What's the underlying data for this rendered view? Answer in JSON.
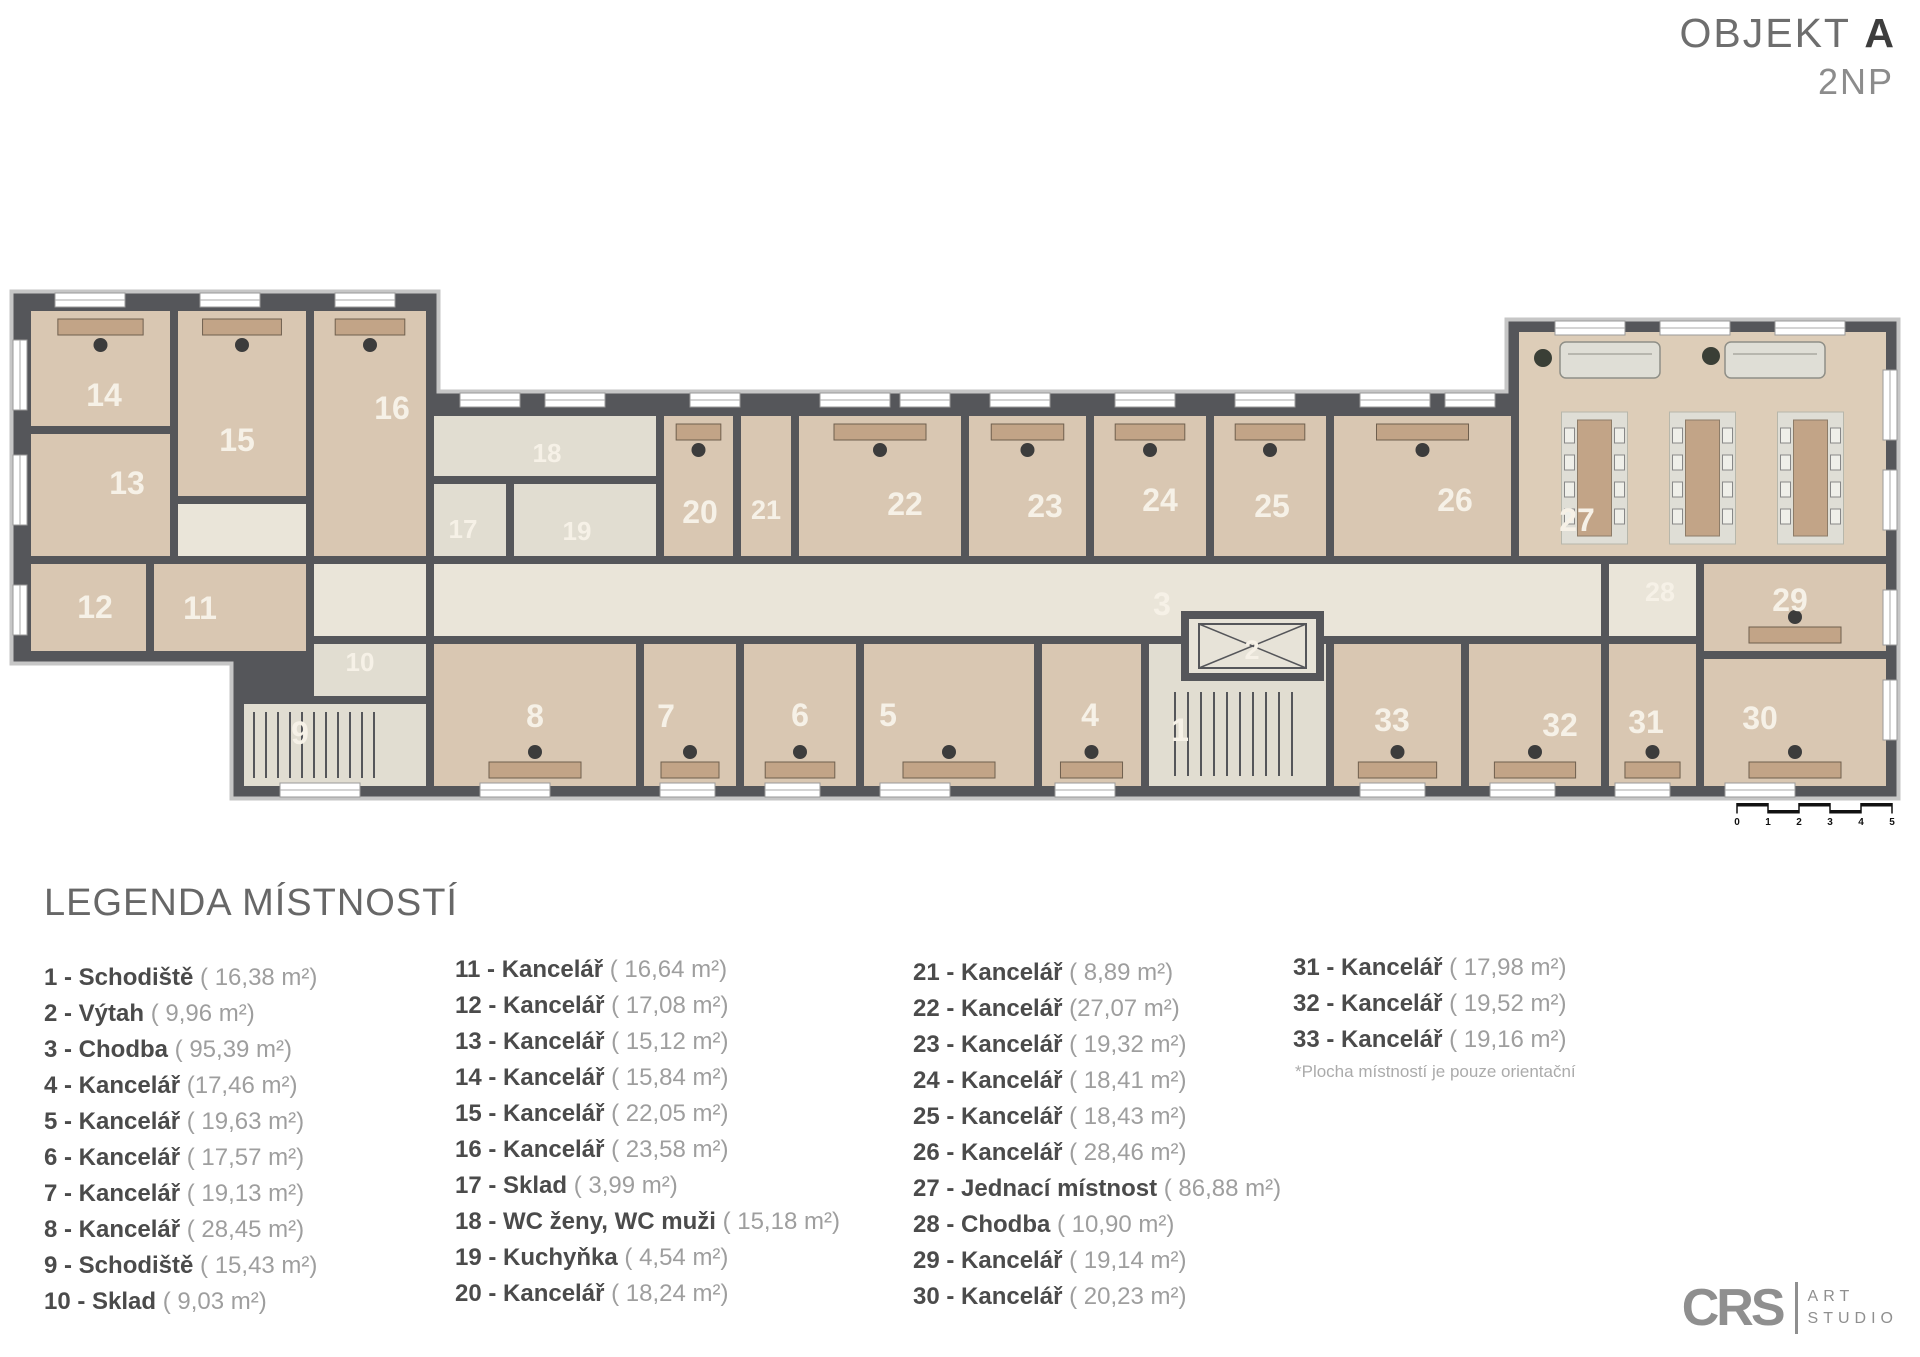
{
  "title": {
    "object": "OBJEKT",
    "object_letter": "A",
    "floor": "2NP"
  },
  "legend": {
    "heading": "LEGENDA MÍSTNOSTÍ",
    "note": "*Plocha místností je pouze orientační",
    "columns": [
      [
        {
          "num": "1",
          "name": "Schodiště",
          "area": "( 16,38 m²)"
        },
        {
          "num": "2",
          "name": "Výtah",
          "area": "( 9,96 m²)"
        },
        {
          "num": "3",
          "name": "Chodba",
          "area": "( 95,39 m²)"
        },
        {
          "num": "4",
          "name": "Kancelář",
          "area": "(17,46  m²)"
        },
        {
          "num": "5",
          "name": "Kancelář",
          "area": "( 19,63 m²)"
        },
        {
          "num": "6",
          "name": "Kancelář",
          "area": "( 17,57 m²)"
        },
        {
          "num": "7",
          "name": "Kancelář",
          "area": "( 19,13 m²)"
        },
        {
          "num": "8",
          "name": "Kancelář",
          "area": "( 28,45 m²)"
        },
        {
          "num": "9",
          "name": "Schodiště",
          "area": "( 15,43 m²)"
        },
        {
          "num": "10",
          "name": "Sklad",
          "area": "( 9,03  m²)"
        }
      ],
      [
        {
          "num": "11",
          "name": "Kancelář",
          "area": "( 16,64 m²)"
        },
        {
          "num": "12",
          "name": "Kancelář",
          "area": "( 17,08 m²)"
        },
        {
          "num": "13",
          "name": "Kancelář",
          "area": "( 15,12 m²)"
        },
        {
          "num": "14",
          "name": "Kancelář",
          "area": "( 15,84 m²)"
        },
        {
          "num": "15",
          "name": "Kancelář",
          "area": "( 22,05 m²)"
        },
        {
          "num": "16",
          "name": "Kancelář",
          "area": "( 23,58 m²)"
        },
        {
          "num": "17",
          "name": "Sklad",
          "area": "( 3,99 m²)"
        },
        {
          "num": "18",
          "name": "WC ženy, WC muži",
          "area": "( 15,18 m²)"
        },
        {
          "num": "19",
          "name": "Kuchyňka",
          "area": "( 4,54 m²)"
        },
        {
          "num": "20",
          "name": "Kancelář",
          "area": "( 18,24 m²)"
        }
      ],
      [
        {
          "num": "21",
          "name": "Kancelář",
          "area": "( 8,89 m²)"
        },
        {
          "num": "22",
          "name": "Kancelář",
          "area": "(27,07 m²)"
        },
        {
          "num": "23",
          "name": "Kancelář",
          "area": "( 19,32 m²)"
        },
        {
          "num": "24",
          "name": "Kancelář",
          "area": "( 18,41 m²)"
        },
        {
          "num": "25",
          "name": "Kancelář",
          "area": "( 18,43 m²)"
        },
        {
          "num": "26",
          "name": "Kancelář",
          "area": "( 28,46 m²)"
        },
        {
          "num": "27",
          "name": "Jednací místnost",
          "area": "( 86,88 m²)"
        },
        {
          "num": "28",
          "name": "Chodba",
          "area": "( 10,90 m²)"
        },
        {
          "num": "29",
          "name": "Kancelář",
          "area": "( 19,14 m²)"
        },
        {
          "num": "30",
          "name": "Kancelář",
          "area": "( 20,23 m²)"
        }
      ],
      [
        {
          "num": "31",
          "name": "Kancelář",
          "area": "( 17,98 m²)"
        },
        {
          "num": "32",
          "name": "Kancelář",
          "area": "( 19,52 m²)"
        },
        {
          "num": "33",
          "name": "Kancelář",
          "area": "( 19,16 m²)"
        }
      ]
    ]
  },
  "logo": {
    "initials": "CRS",
    "word1": "ART",
    "word2": "STUDIO"
  },
  "plan": {
    "colors": {
      "wall": "#55565a",
      "roof": "#c6c6c6",
      "office": "#d9c7b2",
      "corridor": "#eae5d9",
      "service": "#e1ddd1",
      "meeting": "#ddcdb8",
      "elevator": "#e7e3d8",
      "label": "#f6f1e7",
      "wood": "#c2a487",
      "chair": "#3c3c3c",
      "mat": "#dfded6",
      "scale": "#111111"
    },
    "outline": "M20,300 L430,300 L430,400 L1515,400 L1515,328 L1890,328 L1890,790 L240,790 L240,655 L20,655 Z",
    "rooms": [
      {
        "num": "14",
        "rect": [
          27,
          307,
          147,
          123
        ],
        "fill": "office",
        "label": [
          104,
          395
        ],
        "furn": "desk-top"
      },
      {
        "num": "15",
        "rect": [
          174,
          307,
          136,
          193
        ],
        "fill": "office",
        "label": [
          237,
          440
        ],
        "furn": "desk-top"
      },
      {
        "num": "16",
        "rect": [
          310,
          307,
          120,
          253
        ],
        "fill": "office",
        "label": [
          392,
          408
        ],
        "furn": "desk-top"
      },
      {
        "num": "13",
        "rect": [
          27,
          430,
          147,
          130
        ],
        "fill": "office",
        "label": [
          127,
          483
        ],
        "furn": "none"
      },
      {
        "num": "",
        "rect": [
          174,
          500,
          136,
          60
        ],
        "fill": "corridor",
        "furn": "none"
      },
      {
        "num": "12",
        "rect": [
          27,
          560,
          123,
          95
        ],
        "fill": "office",
        "label": [
          95,
          607
        ],
        "furn": "none"
      },
      {
        "num": "11",
        "rect": [
          150,
          560,
          160,
          95
        ],
        "fill": "office",
        "label": [
          200,
          608
        ],
        "furn": "none"
      },
      {
        "num": "",
        "rect": [
          310,
          560,
          120,
          95
        ],
        "fill": "corridor",
        "furn": "none"
      },
      {
        "num": "10",
        "rect": [
          310,
          640,
          120,
          60
        ],
        "fill": "service",
        "label": [
          360,
          662
        ],
        "size": 26,
        "furn": "none"
      },
      {
        "num": "9",
        "rect": [
          240,
          700,
          190,
          90
        ],
        "fill": "service",
        "label": [
          300,
          733
        ],
        "furn": "stairs-h"
      },
      {
        "num": "3",
        "rect": [
          430,
          560,
          1175,
          80
        ],
        "fill": "corridor",
        "label": [
          1162,
          604
        ],
        "furn": "none"
      },
      {
        "num": "18",
        "rect": [
          430,
          412,
          230,
          68
        ],
        "fill": "service",
        "label": [
          547,
          453
        ],
        "size": 26,
        "furn": "none"
      },
      {
        "num": "17",
        "rect": [
          430,
          480,
          80,
          80
        ],
        "fill": "service",
        "label": [
          463,
          529
        ],
        "size": 26,
        "furn": "none"
      },
      {
        "num": "19",
        "rect": [
          510,
          480,
          150,
          80
        ],
        "fill": "service",
        "label": [
          577,
          531
        ],
        "size": 26,
        "furn": "none"
      },
      {
        "num": "20",
        "rect": [
          660,
          412,
          77,
          148
        ],
        "fill": "office",
        "label": [
          700,
          512
        ],
        "furn": "desk-top"
      },
      {
        "num": "21",
        "rect": [
          737,
          412,
          58,
          148
        ],
        "fill": "office",
        "label": [
          766,
          510
        ],
        "size": 27,
        "furn": "none"
      },
      {
        "num": "22",
        "rect": [
          795,
          412,
          170,
          148
        ],
        "fill": "office",
        "label": [
          905,
          504
        ],
        "furn": "desk-top"
      },
      {
        "num": "23",
        "rect": [
          965,
          412,
          125,
          148
        ],
        "fill": "office",
        "label": [
          1045,
          506
        ],
        "furn": "desk-top"
      },
      {
        "num": "24",
        "rect": [
          1090,
          412,
          120,
          148
        ],
        "fill": "office",
        "label": [
          1160,
          500
        ],
        "furn": "desk-top"
      },
      {
        "num": "25",
        "rect": [
          1210,
          412,
          120,
          148
        ],
        "fill": "office",
        "label": [
          1272,
          506
        ],
        "furn": "desk-top"
      },
      {
        "num": "26",
        "rect": [
          1330,
          412,
          185,
          148
        ],
        "fill": "office",
        "label": [
          1455,
          500
        ],
        "furn": "desk-top"
      },
      {
        "num": "27",
        "rect": [
          1515,
          328,
          375,
          232
        ],
        "fill": "meeting",
        "label": [
          1577,
          520
        ],
        "furn": "meeting"
      },
      {
        "num": "28",
        "rect": [
          1605,
          560,
          95,
          80
        ],
        "fill": "corridor",
        "label": [
          1660,
          592
        ],
        "size": 27,
        "furn": "none"
      },
      {
        "num": "29",
        "rect": [
          1700,
          560,
          190,
          95
        ],
        "fill": "office",
        "label": [
          1790,
          600
        ],
        "furn": "desk-bottom"
      },
      {
        "num": "8",
        "rect": [
          430,
          640,
          210,
          150
        ],
        "fill": "office",
        "label": [
          535,
          716
        ],
        "furn": "desk-bottom"
      },
      {
        "num": "7",
        "rect": [
          640,
          640,
          100,
          150
        ],
        "fill": "office",
        "label": [
          666,
          716
        ],
        "furn": "desk-bottom"
      },
      {
        "num": "6",
        "rect": [
          740,
          640,
          120,
          150
        ],
        "fill": "office",
        "label": [
          800,
          715
        ],
        "furn": "desk-bottom"
      },
      {
        "num": "5",
        "rect": [
          860,
          640,
          178,
          150
        ],
        "fill": "office",
        "label": [
          888,
          715
        ],
        "furn": "desk-bottom"
      },
      {
        "num": "4",
        "rect": [
          1038,
          640,
          107,
          150
        ],
        "fill": "office",
        "label": [
          1090,
          715
        ],
        "furn": "desk-bottom"
      },
      {
        "num": "1",
        "rect": [
          1145,
          640,
          185,
          150
        ],
        "fill": "service",
        "label": [
          1180,
          730
        ],
        "furn": "stairs-v"
      },
      {
        "num": "33",
        "rect": [
          1330,
          640,
          135,
          150
        ],
        "fill": "office",
        "label": [
          1392,
          720
        ],
        "furn": "desk-bottom"
      },
      {
        "num": "32",
        "rect": [
          1465,
          640,
          140,
          150
        ],
        "fill": "office",
        "label": [
          1560,
          725
        ],
        "furn": "desk-bottom"
      },
      {
        "num": "31",
        "rect": [
          1605,
          640,
          95,
          150
        ],
        "fill": "office",
        "label": [
          1646,
          722
        ],
        "furn": "desk-bottom"
      },
      {
        "num": "30",
        "rect": [
          1700,
          655,
          190,
          135
        ],
        "fill": "office",
        "label": [
          1760,
          718
        ],
        "furn": "desk-bottom"
      },
      {
        "num": "2",
        "rect": [
          1185,
          615,
          135,
          62
        ],
        "fill": "elevator",
        "label": [
          1252,
          650
        ],
        "size": 27,
        "furn": "elevator"
      }
    ],
    "windows": [
      [
        55,
        293,
        70,
        14
      ],
      [
        200,
        293,
        60,
        14
      ],
      [
        335,
        293,
        60,
        14
      ],
      [
        13,
        340,
        14,
        70
      ],
      [
        13,
        455,
        14,
        70
      ],
      [
        13,
        585,
        14,
        50
      ],
      [
        460,
        393,
        60,
        14
      ],
      [
        545,
        393,
        60,
        14
      ],
      [
        690,
        393,
        50,
        14
      ],
      [
        820,
        393,
        70,
        14
      ],
      [
        900,
        393,
        50,
        14
      ],
      [
        990,
        393,
        60,
        14
      ],
      [
        1115,
        393,
        60,
        14
      ],
      [
        1235,
        393,
        60,
        14
      ],
      [
        1360,
        393,
        70,
        14
      ],
      [
        1445,
        393,
        50,
        14
      ],
      [
        1555,
        321,
        70,
        14
      ],
      [
        1660,
        321,
        70,
        14
      ],
      [
        1775,
        321,
        70,
        14
      ],
      [
        1883,
        370,
        14,
        70
      ],
      [
        1883,
        470,
        14,
        60
      ],
      [
        1883,
        590,
        14,
        55
      ],
      [
        1883,
        680,
        14,
        60
      ],
      [
        280,
        783,
        80,
        14
      ],
      [
        480,
        783,
        70,
        14
      ],
      [
        660,
        783,
        55,
        14
      ],
      [
        765,
        783,
        55,
        14
      ],
      [
        880,
        783,
        70,
        14
      ],
      [
        1055,
        783,
        60,
        14
      ],
      [
        1360,
        783,
        65,
        14
      ],
      [
        1490,
        783,
        65,
        14
      ],
      [
        1615,
        783,
        55,
        14
      ],
      [
        1725,
        783,
        70,
        14
      ]
    ],
    "scalebar": {
      "x": 1737,
      "y": 803,
      "seg": 31,
      "labels": [
        "0",
        "1",
        "2",
        "3",
        "4",
        "5"
      ]
    }
  }
}
